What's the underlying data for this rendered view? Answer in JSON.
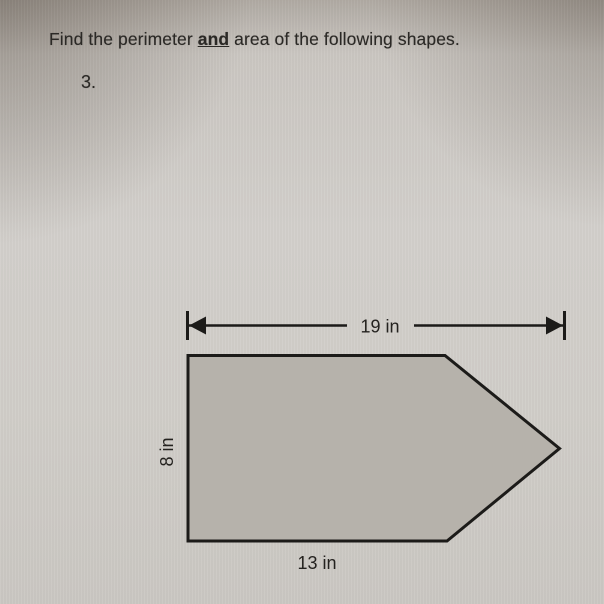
{
  "worksheet": {
    "instruction": {
      "prefix": "Find the perimeter ",
      "emphasis": "and",
      "suffix": " area of the following shapes."
    },
    "problem_number": "3."
  },
  "figure": {
    "shape_type": "pentagon",
    "labels": {
      "top_width": "19 in",
      "left_height": "8 in",
      "bottom_width": "13 in"
    },
    "colors": {
      "shape_fill": "#b6b2ab",
      "shape_outline": "#1c1b19",
      "dimension_line": "#1c1b19",
      "paper_background": "#d1cec9",
      "text": "#2b2926"
    }
  }
}
